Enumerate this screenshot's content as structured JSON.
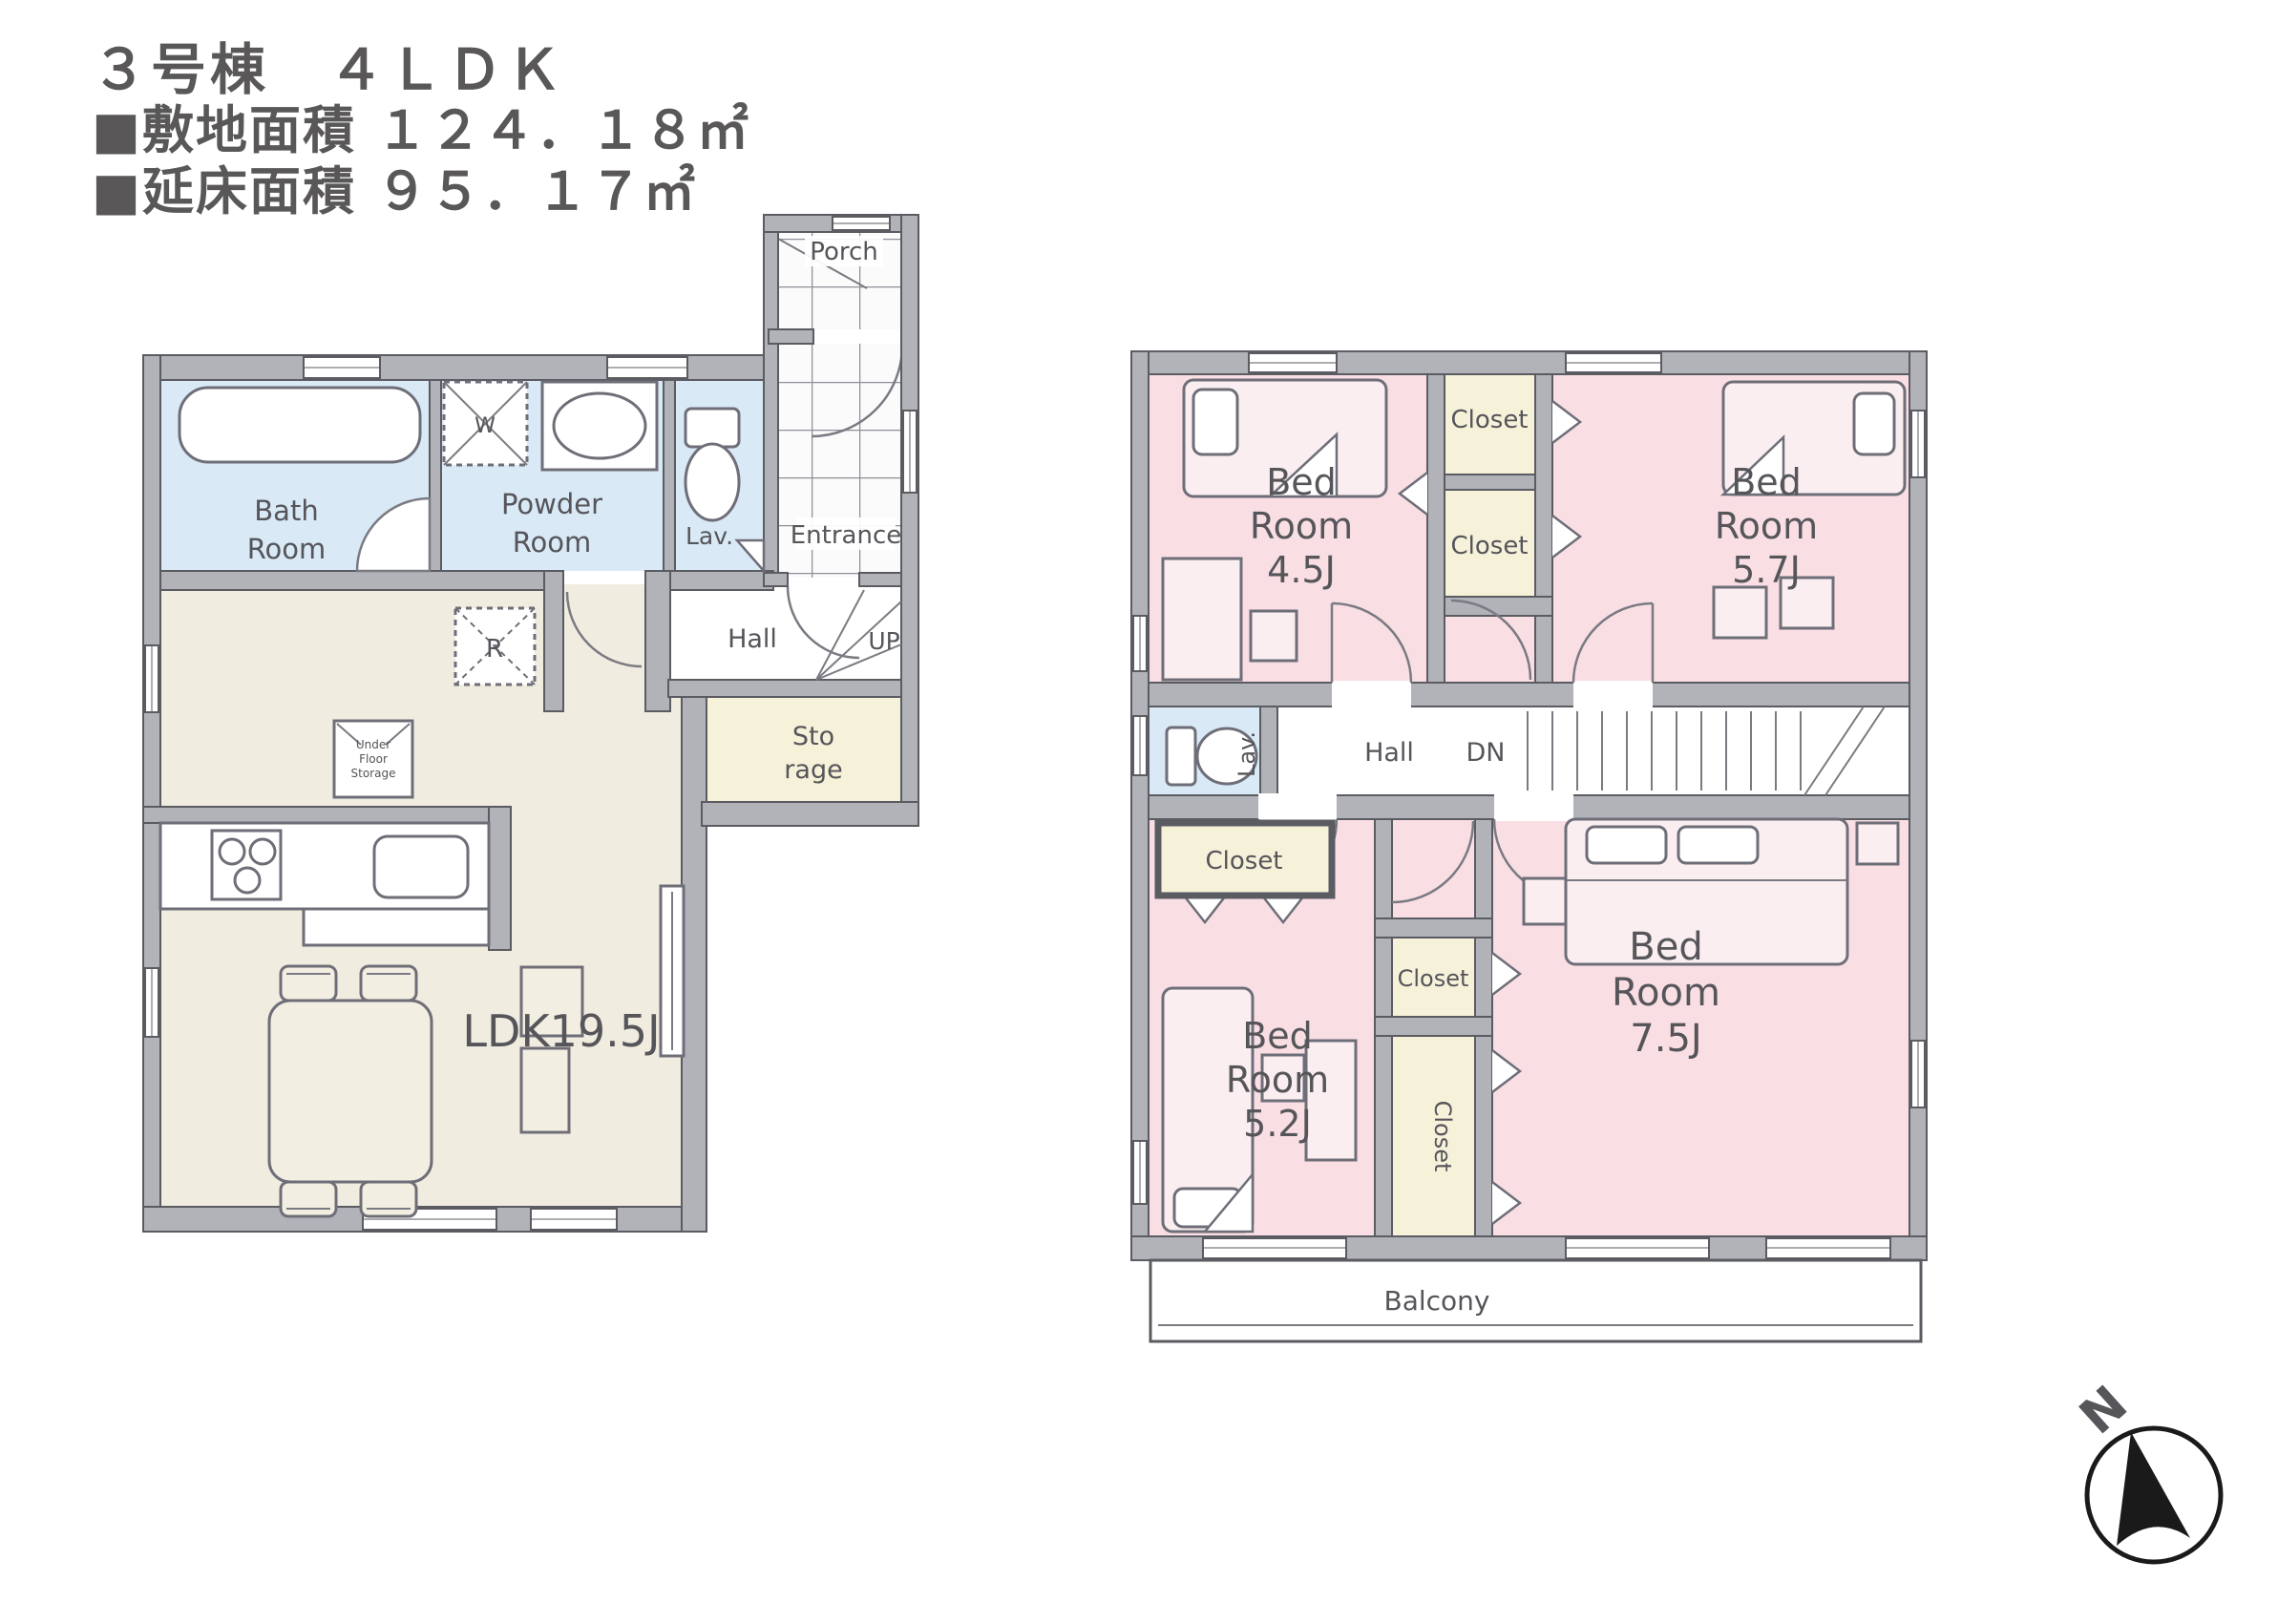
{
  "header": {
    "building": "３号棟　４ＬＤＫ",
    "site_area": "■敷地面積 １２４．１８㎡",
    "floor_area": "■延床面積 ９５．１７㎡"
  },
  "floor1": {
    "bath_room": {
      "l1": "Bath",
      "l2": "Room"
    },
    "powder_room": {
      "l1": "Powder",
      "l2": "Room"
    },
    "washer": "W",
    "lav": "Lav.",
    "porch": "Porch",
    "entrance": "Entrance",
    "hall": "Hall",
    "up": "UP",
    "storage": {
      "l1": "Sto",
      "l2": "rage"
    },
    "refrigerator": "R",
    "under_floor_storage": {
      "l1": "Under",
      "l2": "Floor",
      "l3": "Storage"
    },
    "ldk": "LDK19.5J"
  },
  "floor2": {
    "bedroom_45": {
      "l1": "Bed",
      "l2": "Room",
      "l3": "4.5J"
    },
    "bedroom_57": {
      "l1": "Bed",
      "l2": "Room",
      "l3": "5.7J"
    },
    "bedroom_52": {
      "l1": "Bed",
      "l2": "Room",
      "l3": "5.2J"
    },
    "bedroom_75": {
      "l1": "Bed",
      "l2": "Room",
      "l3": "7.5J"
    },
    "closet_top_a": "Closet",
    "closet_top_b": "Closet",
    "closet_left": "Closet",
    "closet_mid": "Closet",
    "closet_tall": "Closet",
    "lav": "Lav.",
    "hall": "Hall",
    "dn": "DN",
    "balcony": "Balcony"
  },
  "compass": {
    "north": "N"
  },
  "colors": {
    "room_blue": "#d9e9f6",
    "room_pink": "#f9dfe4",
    "closet_cream": "#f6f1d9",
    "ldk_beige": "#f1ece0",
    "wall_gray": "#b2b2b9",
    "text_gray": "#595757"
  }
}
